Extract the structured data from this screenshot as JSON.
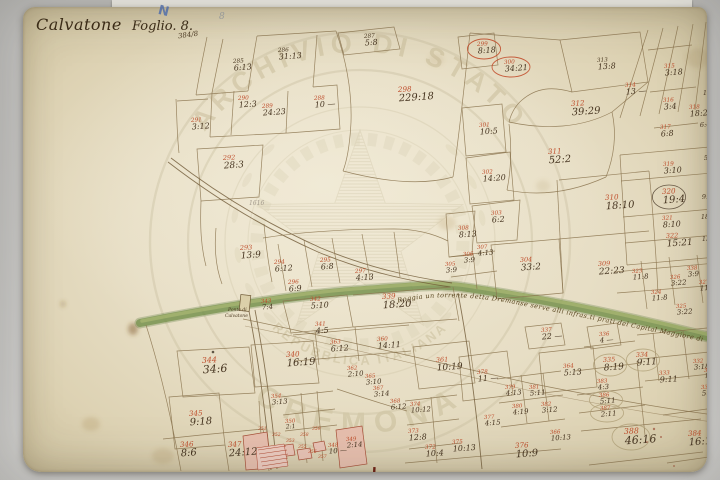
{
  "title": {
    "place": "Calvatone",
    "sheet": "Foglio. 8.",
    "fraction": "384/8",
    "pencil_letter": "N",
    "pencil_number": "8",
    "pencil_note": "1616"
  },
  "watermark": {
    "outer_top": "ARCHIVIO DI STATO",
    "outer_bottom": "CREMONA",
    "inner": "REPUBBLICA ITALIANA"
  },
  "river": {
    "label": "Roggia un torrente detta Dremanse serve alli infras.ti prati del Capital Maggiore di"
  },
  "bridge": {
    "line1": "Ponte di",
    "line2": "Calvatone"
  },
  "colors": {
    "paper": "#e7dec5",
    "background": "#c7c6c4",
    "ink": "#8a734d",
    "parcel_id": "#bf4e2c",
    "value_ink": "#463420",
    "green_band": "#75914c",
    "pink_building": "#e7bfae",
    "watermark": "#c3b893",
    "pencil_blue": "#5574b5"
  },
  "map": {
    "parcels": [
      {
        "id": "285",
        "v": "6:13",
        "x": 233,
        "y": 63,
        "ink": "dark"
      },
      {
        "id": "286",
        "v": "31:13",
        "x": 278,
        "y": 52,
        "ink": "dark"
      },
      {
        "id": "287",
        "v": "5:8",
        "x": 364,
        "y": 38,
        "ink": "dark"
      },
      {
        "id": "288",
        "v": "10 —",
        "x": 314,
        "y": 100
      },
      {
        "id": "289",
        "v": "24:23",
        "x": 262,
        "y": 108
      },
      {
        "id": "290",
        "v": "12:3",
        "x": 238,
        "y": 100
      },
      {
        "id": "291",
        "v": "3:12",
        "x": 191,
        "y": 122
      },
      {
        "id": "292",
        "v": "28:3",
        "x": 223,
        "y": 160,
        "s": 9
      },
      {
        "id": "298",
        "v": "229:18",
        "x": 398,
        "y": 92,
        "s": 10
      },
      {
        "id": "299",
        "v": "8:18",
        "x": 477,
        "y": 46,
        "circ": "red"
      },
      {
        "id": "300",
        "v": "34:21",
        "x": 504,
        "y": 64,
        "circ": "red"
      },
      {
        "id": "301",
        "v": "10:5",
        "x": 479,
        "y": 127
      },
      {
        "id": "302",
        "v": "14:20",
        "x": 482,
        "y": 174
      },
      {
        "id": "311",
        "v": "52:2",
        "x": 548,
        "y": 154,
        "s": 10
      },
      {
        "id": "312",
        "v": "39:29",
        "x": 571,
        "y": 106,
        "s": 10
      },
      {
        "id": "313",
        "v": "13:8",
        "x": 597,
        "y": 62,
        "ink": "dark"
      },
      {
        "id": "314",
        "v": "13 —",
        "x": 625,
        "y": 87
      },
      {
        "id": "315",
        "v": "3:18",
        "x": 664,
        "y": 68
      },
      {
        "id": "316",
        "v": "3:4",
        "x": 663,
        "y": 102
      },
      {
        "id": "317",
        "v": "6:8",
        "x": 660,
        "y": 129
      },
      {
        "id": "318",
        "v": "18:2",
        "x": 689,
        "y": 109
      },
      {
        "id": "319",
        "v": "3:10",
        "x": 663,
        "y": 166
      },
      {
        "id": "320",
        "v": "19:4",
        "x": 662,
        "y": 194,
        "circ": "dark",
        "s": 10
      },
      {
        "id": "321",
        "v": "8:10",
        "x": 662,
        "y": 220
      },
      {
        "id": "322",
        "v": "15:21",
        "x": 666,
        "y": 238,
        "s": 9
      },
      {
        "id": "310",
        "v": "18:10",
        "x": 605,
        "y": 200,
        "s": 10
      },
      {
        "id": "309",
        "v": "22:23",
        "x": 598,
        "y": 266,
        "s": 9
      },
      {
        "id": "303",
        "v": "6:2",
        "x": 491,
        "y": 215
      },
      {
        "id": "308",
        "v": "8:13",
        "x": 458,
        "y": 230
      },
      {
        "id": "307",
        "v": "4:13",
        "x": 477,
        "y": 249,
        "s": 7
      },
      {
        "id": "306",
        "v": "3:9",
        "x": 463,
        "y": 256,
        "s": 7
      },
      {
        "id": "305",
        "v": "3:9",
        "x": 445,
        "y": 266,
        "s": 7
      },
      {
        "id": "304",
        "v": "33:2",
        "x": 520,
        "y": 262,
        "s": 9
      },
      {
        "id": "293",
        "v": "13:9",
        "x": 240,
        "y": 250,
        "s": 9
      },
      {
        "id": "294",
        "v": "6:12",
        "x": 274,
        "y": 264
      },
      {
        "id": "295",
        "v": "6:8",
        "x": 320,
        "y": 262
      },
      {
        "id": "296",
        "v": "6:9",
        "x": 288,
        "y": 284
      },
      {
        "id": "297",
        "v": "4:13",
        "x": 355,
        "y": 273
      },
      {
        "id": "323",
        "v": "11:8",
        "x": 632,
        "y": 273,
        "s": 7
      },
      {
        "id": "326",
        "v": "3:22",
        "x": 670,
        "y": 279,
        "s": 7
      },
      {
        "id": "327",
        "v": "11:13",
        "x": 699,
        "y": 284,
        "s": 7
      },
      {
        "id": "324",
        "v": "11:8",
        "x": 651,
        "y": 294,
        "s": 7
      },
      {
        "id": "325",
        "v": "3:22",
        "x": 676,
        "y": 308,
        "s": 7
      },
      {
        "id": "338",
        "v": "3:9",
        "x": 687,
        "y": 270,
        "s": 7
      },
      {
        "id": "343",
        "v": "7:4",
        "x": 261,
        "y": 303,
        "s": 7
      },
      {
        "id": "342",
        "v": "5:10",
        "x": 310,
        "y": 301
      },
      {
        "id": "339",
        "v": "18:20",
        "x": 382,
        "y": 299,
        "s": 10
      },
      {
        "id": "341",
        "v": "4:5",
        "x": 315,
        "y": 326
      },
      {
        "id": "363",
        "v": "6:12",
        "x": 330,
        "y": 344
      },
      {
        "id": "360",
        "v": "14:11",
        "x": 377,
        "y": 341
      },
      {
        "id": "340",
        "v": "16:19",
        "x": 286,
        "y": 357,
        "s": 10
      },
      {
        "id": "344",
        "v": "34:6",
        "x": 202,
        "y": 363,
        "s": 11
      },
      {
        "id": "345",
        "v": "9:18",
        "x": 189,
        "y": 416,
        "s": 10
      },
      {
        "id": "346",
        "v": "8:6",
        "x": 180,
        "y": 447,
        "s": 10
      },
      {
        "id": "347",
        "v": "24:12",
        "x": 228,
        "y": 447,
        "s": 10
      },
      {
        "id": "362",
        "v": "2:10",
        "x": 347,
        "y": 370,
        "s": 7
      },
      {
        "id": "365",
        "v": "3:10",
        "x": 365,
        "y": 378,
        "s": 7
      },
      {
        "id": "367",
        "v": "3:14",
        "x": 373,
        "y": 390,
        "s": 7
      },
      {
        "id": "368",
        "v": "6:12",
        "x": 390,
        "y": 403,
        "s": 7
      },
      {
        "id": "354",
        "v": "3:13",
        "x": 271,
        "y": 398,
        "s": 7
      },
      {
        "id": "350",
        "v": "2:1",
        "x": 285,
        "y": 423,
        "s": 6
      },
      {
        "id": "349",
        "v": "2:14",
        "x": 346,
        "y": 441,
        "s": 7
      },
      {
        "id": "348",
        "v": "10 —",
        "x": 328,
        "y": 447,
        "s": 7
      },
      {
        "id": "361",
        "v": "10:19",
        "x": 436,
        "y": 362,
        "s": 9
      },
      {
        "id": "378",
        "v": "11 —",
        "x": 477,
        "y": 374
      },
      {
        "id": "364",
        "v": "5:13",
        "x": 563,
        "y": 368
      },
      {
        "id": "379",
        "v": "4:13",
        "x": 505,
        "y": 389,
        "s": 7
      },
      {
        "id": "381",
        "v": "5:11",
        "x": 529,
        "y": 389,
        "s": 7
      },
      {
        "id": "380",
        "v": "4:19",
        "x": 512,
        "y": 408,
        "s": 7
      },
      {
        "id": "382",
        "v": "3:12",
        "x": 541,
        "y": 406,
        "s": 7
      },
      {
        "id": "377",
        "v": "4:15",
        "x": 484,
        "y": 419,
        "s": 7
      },
      {
        "id": "375",
        "v": "10:13",
        "x": 452,
        "y": 444,
        "s": 8
      },
      {
        "id": "376",
        "v": "10:9",
        "x": 515,
        "y": 448,
        "s": 10
      },
      {
        "id": "374",
        "v": "10:12",
        "x": 410,
        "y": 406,
        "s": 7
      },
      {
        "id": "373",
        "v": "12:8",
        "x": 408,
        "y": 433,
        "s": 8
      },
      {
        "id": "372",
        "v": "10:4",
        "x": 425,
        "y": 449,
        "s": 8
      },
      {
        "id": "366",
        "v": "10:13",
        "x": 550,
        "y": 434,
        "s": 7
      },
      {
        "id": "383",
        "v": "4:3",
        "x": 597,
        "y": 383,
        "s": 7
      },
      {
        "id": "386",
        "v": "5:11",
        "x": 599,
        "y": 397,
        "s": 7,
        "circ": "light"
      },
      {
        "id": "387",
        "v": "2:11",
        "x": 600,
        "y": 410,
        "s": 7,
        "circ": "light"
      },
      {
        "id": "388",
        "v": "46:16",
        "x": 624,
        "y": 434,
        "s": 11,
        "circ": "light"
      },
      {
        "id": "384",
        "v": "16:13",
        "x": 688,
        "y": 436,
        "s": 10
      },
      {
        "id": "337",
        "v": "22 —",
        "x": 541,
        "y": 332,
        "s": 8
      },
      {
        "id": "336",
        "v": "4 —",
        "x": 599,
        "y": 336,
        "s": 7
      },
      {
        "id": "335",
        "v": "8:19",
        "x": 603,
        "y": 362,
        "s": 9,
        "circ": "light"
      },
      {
        "id": "334",
        "v": "9:11",
        "x": 636,
        "y": 357,
        "s": 9,
        "circ": "light"
      },
      {
        "id": "333",
        "v": "9:11",
        "x": 659,
        "y": 375,
        "s": 8
      },
      {
        "id": "332",
        "v": "3:18",
        "x": 693,
        "y": 363,
        "s": 7
      },
      {
        "id": "330",
        "v": "1:8",
        "x": 704,
        "y": 372,
        "s": 6
      },
      {
        "id": "331",
        "v": "5:11",
        "x": 701,
        "y": 389,
        "s": 7
      }
    ],
    "village_ids": [
      {
        "id": "351",
        "x": 258,
        "y": 430
      },
      {
        "id": "352",
        "x": 272,
        "y": 436
      },
      {
        "id": "353",
        "x": 286,
        "y": 442
      },
      {
        "id": "355",
        "x": 298,
        "y": 448
      },
      {
        "id": "356",
        "x": 308,
        "y": 453
      },
      {
        "id": "357",
        "x": 318,
        "y": 458
      },
      {
        "id": "358",
        "x": 300,
        "y": 436
      },
      {
        "id": "359",
        "x": 312,
        "y": 430
      }
    ],
    "edge_values": [
      {
        "v": "13:2",
        "x": 703,
        "y": 95
      },
      {
        "v": "6:4",
        "x": 700,
        "y": 127
      },
      {
        "v": "5:10",
        "x": 704,
        "y": 160
      },
      {
        "v": "9:4",
        "x": 702,
        "y": 199
      },
      {
        "v": "18:",
        "x": 701,
        "y": 219
      },
      {
        "v": "13:12",
        "x": 702,
        "y": 241
      }
    ]
  }
}
